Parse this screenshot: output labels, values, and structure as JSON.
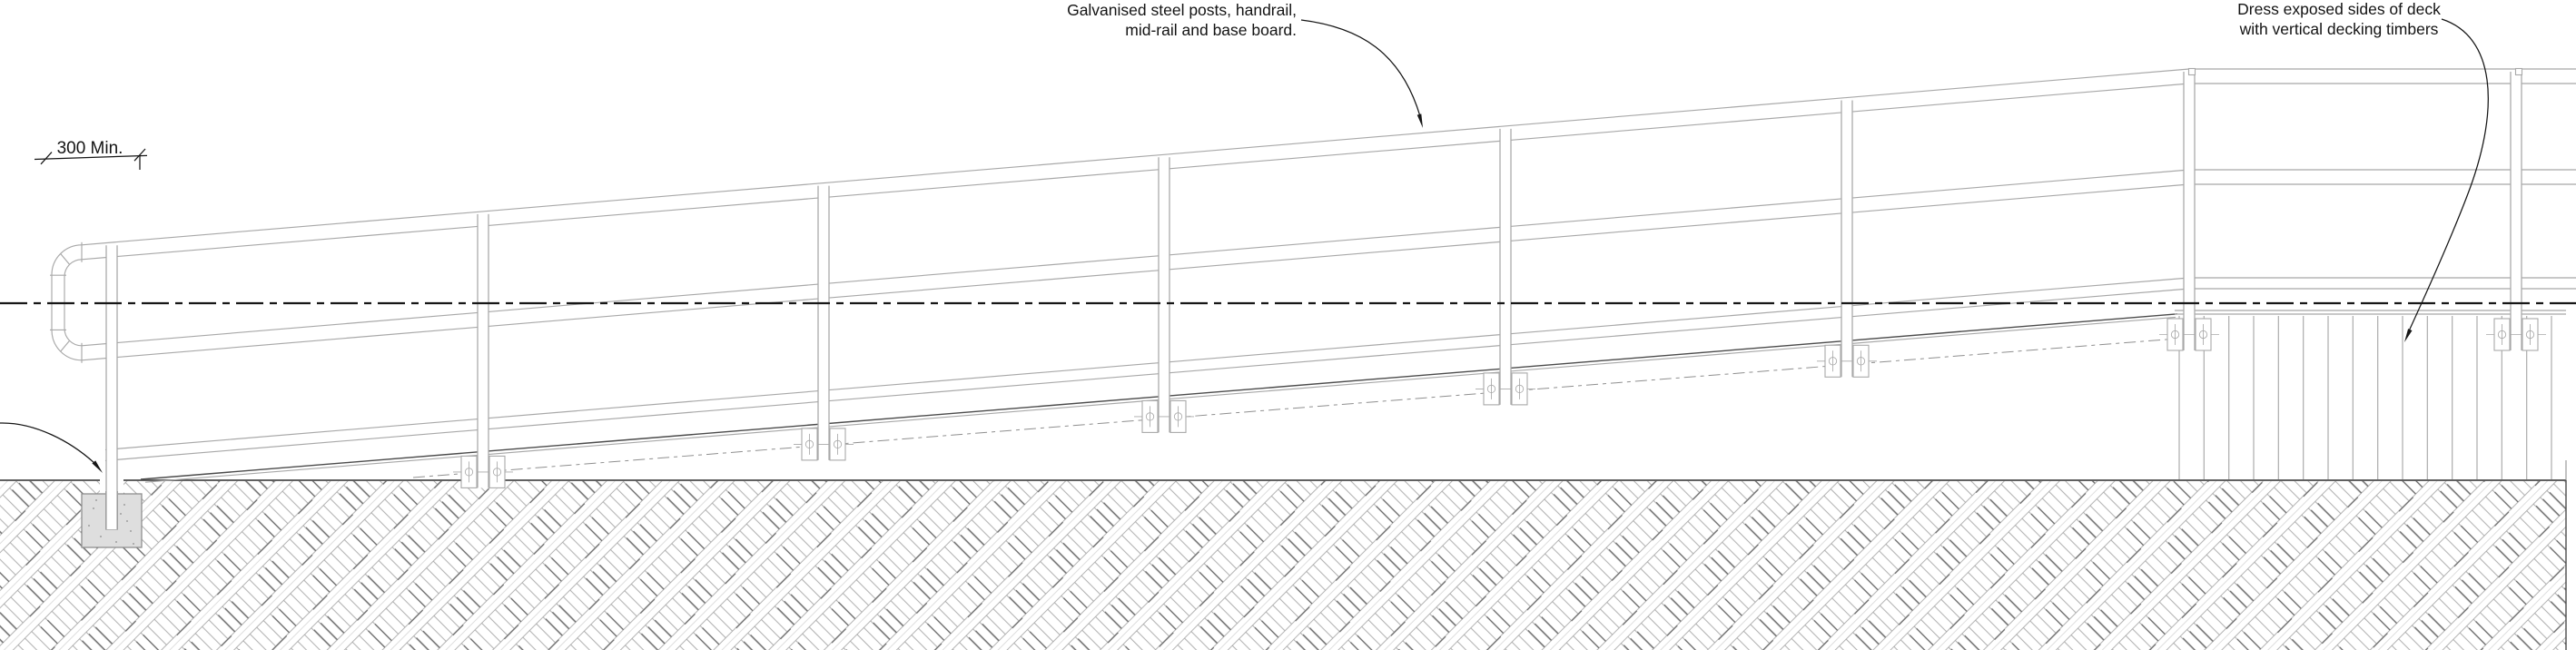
{
  "drawing": {
    "annotations": {
      "posts_note_line1": "Galvanised steel posts, handrail,",
      "posts_note_line2": "mid-rail and base board.",
      "deck_note_line1": "Dress exposed sides of deck",
      "deck_note_line2": "with vertical decking timbers",
      "dimension_label": "300 Min."
    },
    "colors": {
      "ink": "#161616",
      "line_light": "#a8a8a8",
      "line_mid": "#8f8f8f",
      "line_dark": "#4b4b4b",
      "hatch_light": "#b5b5b5",
      "hatch_mid": "#a2a2a2",
      "hatch_dark": "#5f5f5f",
      "footing_fill": "#dedede",
      "paper": "#ffffff"
    }
  }
}
